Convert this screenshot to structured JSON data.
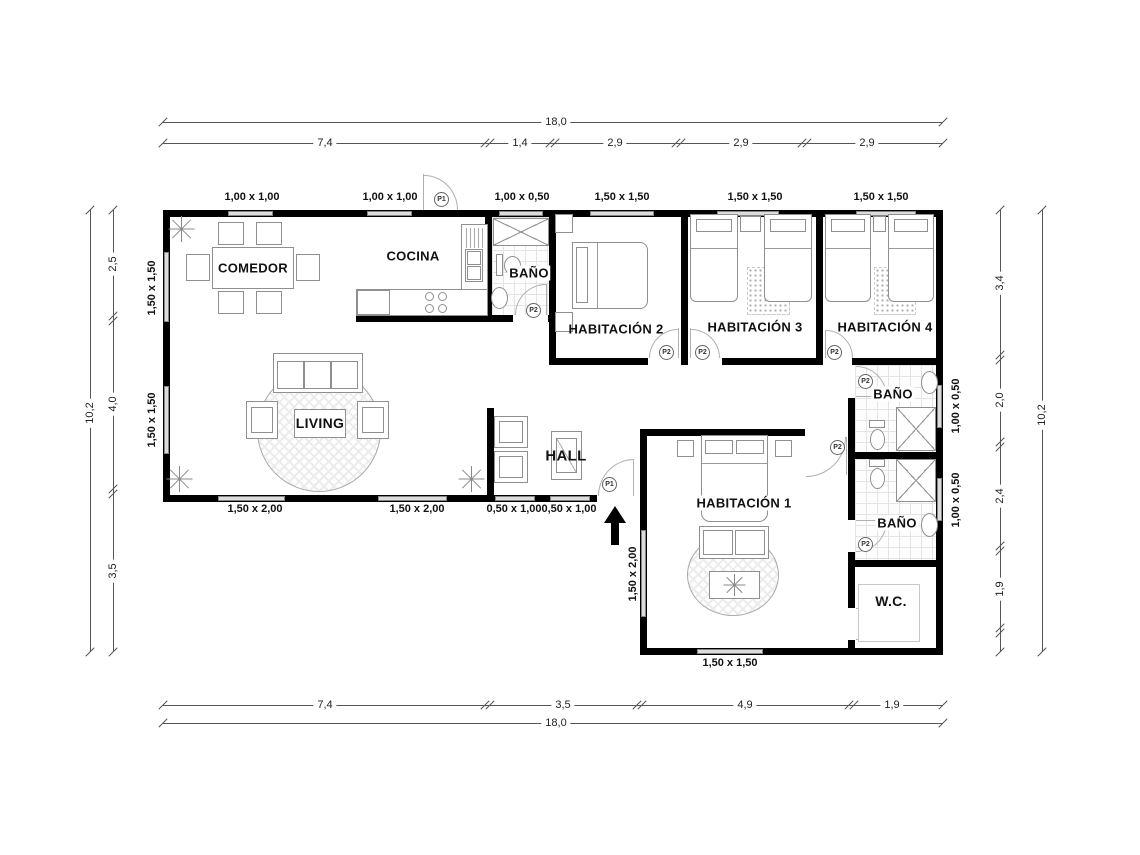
{
  "plan": {
    "rooms": {
      "comedor": "COMEDOR",
      "cocina": "COCINA",
      "bano_top": "BAÑO",
      "habitacion2": "HABITACIÓN 2",
      "habitacion3": "HABITACIÓN 3",
      "habitacion4": "HABITACIÓN 4",
      "living": "LIVING",
      "hall": "HALL",
      "habitacion1": "HABITACIÓN 1",
      "bano_upper": "BAÑO",
      "bano_lower": "BAÑO",
      "wc": "W.C."
    },
    "doors": {
      "p1": "P1",
      "p2": "P2"
    },
    "windows": {
      "top": [
        "1,00 x 1,00",
        "1,00 x 1,00",
        "1,00 x 0,50",
        "1,50 x 1,50",
        "1,50 x 1,50",
        "1,50 x 1,50"
      ],
      "left": [
        "1,50 x 1,50",
        "1,50 x 1,50"
      ],
      "bottom": [
        "1,50 x 2,00",
        "1,50 x 2,00",
        "0,50 x 1,00",
        "0,50 x 1,00"
      ],
      "hab1_left": "1,50 x 2,00",
      "hab1_bottom": "1,50 x 1,50",
      "right": [
        "1,00 x 0,50",
        "1,00 x 0,50"
      ]
    },
    "dims": {
      "top_total": "18,0",
      "top_segments": [
        "7,4",
        "1,4",
        "2,9",
        "2,9",
        "2,9"
      ],
      "bottom_segments": [
        "7,4",
        "3,5",
        "4,9",
        "1,9"
      ],
      "bottom_total": "18,0",
      "left_total": "10,2",
      "left_segments": [
        "2,5",
        "4,0",
        "3,5"
      ],
      "right_segments": [
        "3,4",
        "2,0",
        "2,4",
        "1,9"
      ],
      "right_total": "10,2"
    }
  }
}
